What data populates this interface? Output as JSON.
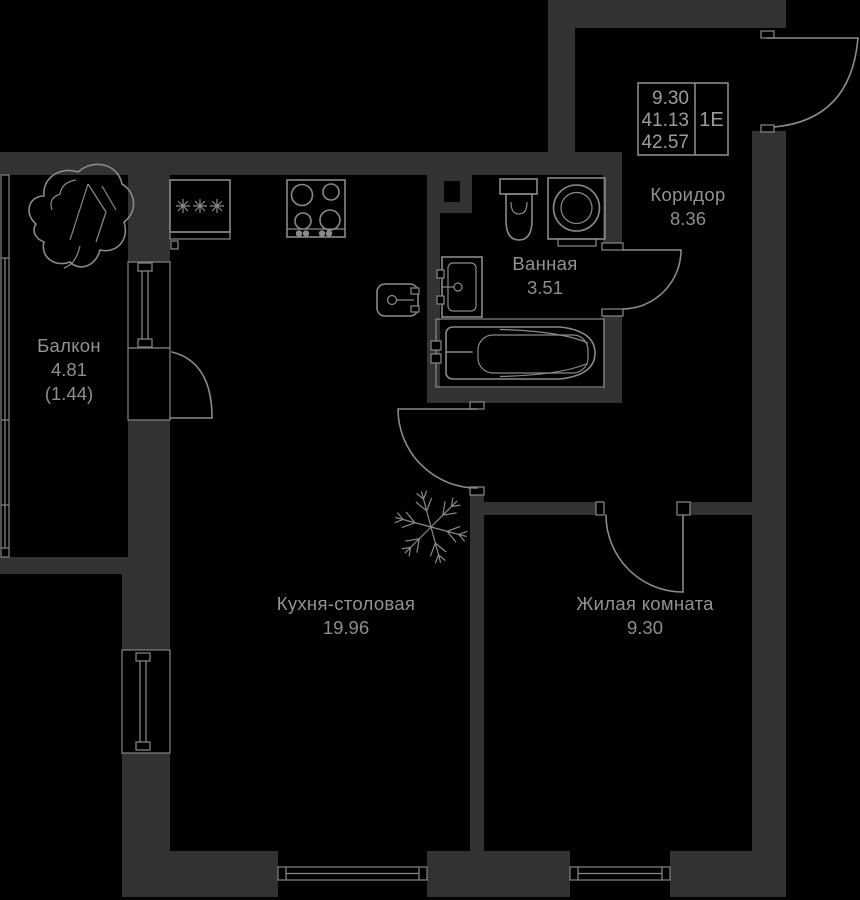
{
  "plan": {
    "title": "apartment-floor-plan",
    "type_label": "1Е",
    "stats": {
      "living_area": "9.30",
      "area_without_balcony": "41.13",
      "total_area": "42.57"
    },
    "rooms": {
      "corridor": {
        "name": "Коридор",
        "area": "8.36"
      },
      "bathroom": {
        "name": "Ванная",
        "area": "3.51"
      },
      "balcony": {
        "name": "Балкон",
        "area": "4.81",
        "area_coeff": "(1.44)"
      },
      "kitchen": {
        "name": "Кухня-столовая",
        "area": "19.96"
      },
      "living": {
        "name": "Жилая комната",
        "area": "9.30"
      }
    },
    "icons": {
      "snowflake": "air-conditioner-spot",
      "stars": "✳✳✳",
      "fixtures": [
        "toilet",
        "washing-machine",
        "sink",
        "bathtub",
        "stove",
        "kitchen-basin"
      ]
    },
    "colors": {
      "background": "#000000",
      "wall": "#323232",
      "line": "#8a8a8a",
      "label": "#929292"
    }
  }
}
